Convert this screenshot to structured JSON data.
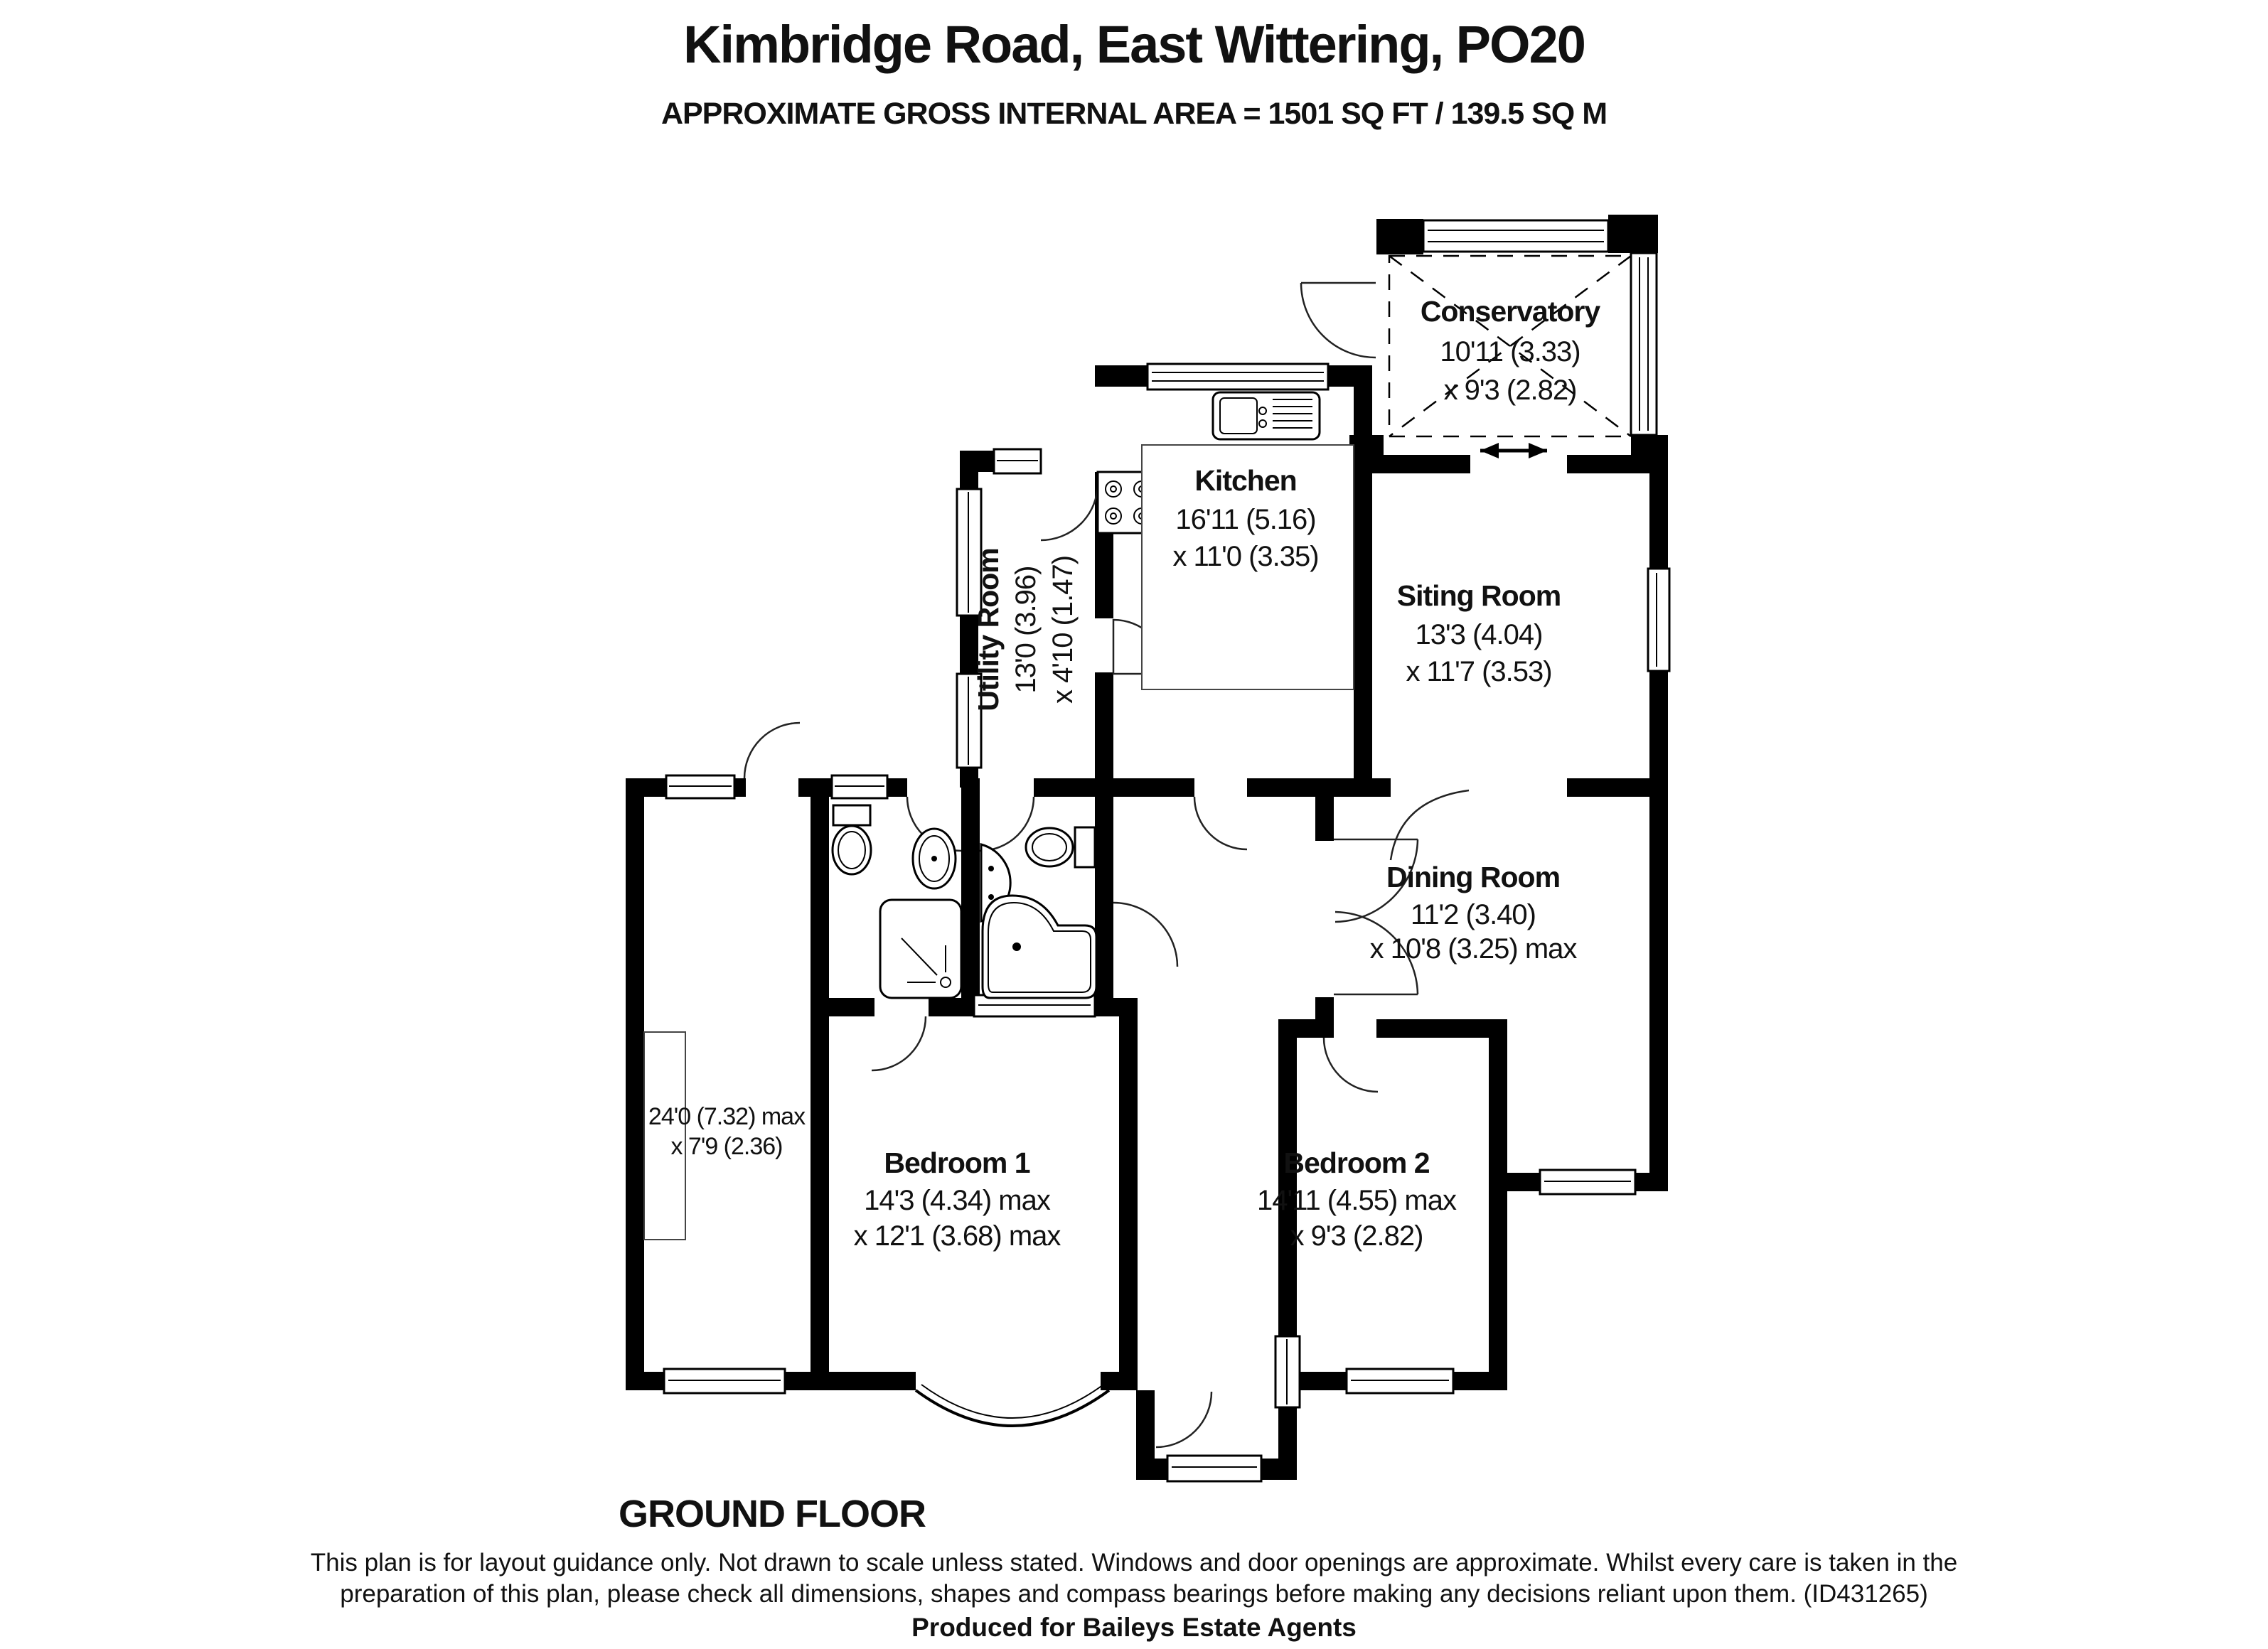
{
  "header": {
    "title": "Kimbridge Road, East Wittering, PO20",
    "subtitle": "APPROXIMATE GROSS INTERNAL AREA = 1501 SQ FT / 139.5 SQ M"
  },
  "rooms": {
    "conservatory": {
      "name": "Conservatory",
      "dim1": "10'11 (3.33)",
      "dim2": "x 9'3 (2.82)"
    },
    "kitchen": {
      "name": "Kitchen",
      "dim1": "16'11 (5.16)",
      "dim2": "x 11'0 (3.35)"
    },
    "utility": {
      "name": "Utility Room",
      "dim1": "13'0 (3.96)",
      "dim2": "x 4'10 (1.47)"
    },
    "sitting": {
      "name": "Siting Room",
      "dim1": "13'3 (4.04)",
      "dim2": "x 11'7 (3.53)"
    },
    "dining": {
      "name": "Dining Room",
      "dim1": "11'2 (3.40)",
      "dim2": "x 10'8 (3.25) max"
    },
    "bedroom1": {
      "name": "Bedroom 1",
      "dim1": "14'3 (4.34) max",
      "dim2": "x 12'1 (3.68) max"
    },
    "bedroom2": {
      "name": "Bedroom 2",
      "dim1": "14'11 (4.55) max",
      "dim2": "x 9'3 (2.82)"
    },
    "garage": {
      "dim1": "24'0 (7.32) max",
      "dim2": "x 7'9 (2.36)"
    }
  },
  "footer": {
    "floor_label": "GROUND FLOOR",
    "disclaimer_line1": "This plan is for layout guidance only. Not drawn to scale unless stated. Windows and door openings are approximate. Whilst every care is taken in the",
    "disclaimer_line2": "preparation of this plan, please check all dimensions, shapes and compass bearings before making any decisions reliant upon them. (ID431265)",
    "produced_by": "Produced for Baileys Estate Agents"
  },
  "colors": {
    "walls": "#000000",
    "background": "#ffffff"
  }
}
